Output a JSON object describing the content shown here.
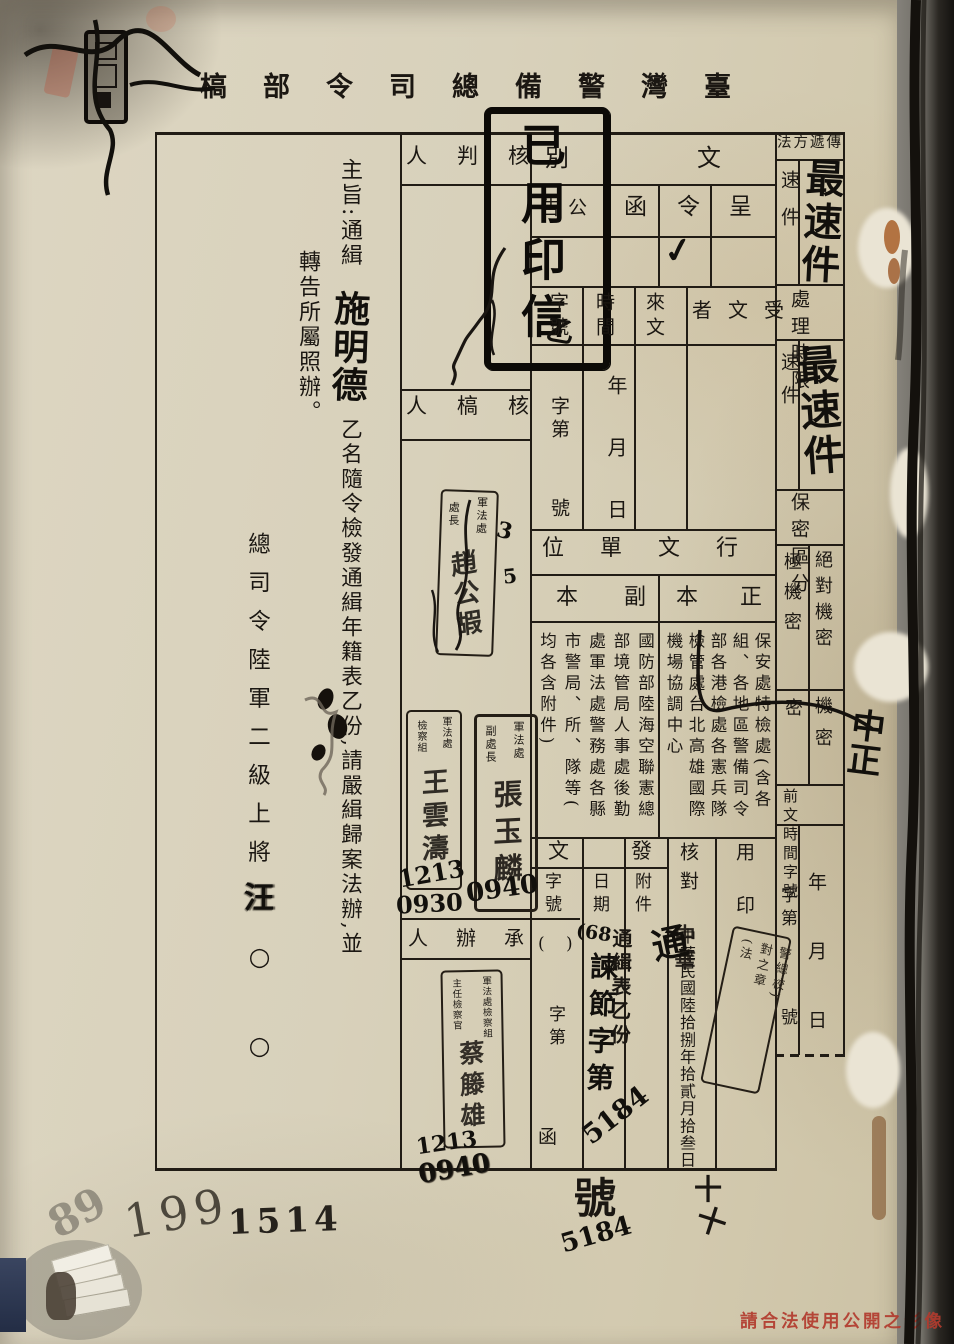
{
  "header": {
    "title": "臺灣警備總司令部槁"
  },
  "subject": {
    "label_and_opening": "主旨:通緝",
    "fugitive_name_hw": "施明德",
    "body_rest": "乙名隨令檢發通緝年籍表乙份,請嚴緝歸案法辦,並",
    "body_line2": "轉告所屬照辦。",
    "signer_title": "總司令陸軍二級上將",
    "signer_name_hw": "汪",
    "name_placeholders": "○○"
  },
  "doc_type": {
    "label": "文別",
    "options": [
      "呈",
      "令",
      "函",
      "公告"
    ],
    "check": "✓",
    "seal_box": {
      "text": "已用印信",
      "hw_note": "乙"
    }
  },
  "incoming": {
    "receiver_label": "受文者",
    "source_label": "來文",
    "time_label": "時間",
    "time_template": "年月日",
    "number_label": "字號",
    "number_prefix": "字第",
    "number_suffix": "號"
  },
  "dispatch_units": {
    "section_label": "行文單位",
    "original_label": "正本",
    "original_columns": [
      "保安處特檢處(含各",
      "組、各地區警備司令",
      "部各港檢處各憲兵隊",
      "檢管處台北高雄國際",
      "機場協調中心"
    ],
    "copy_label": "副本",
    "copy_columns": [
      "國防部陸海空聯憲總",
      "部境管局人事處後勤",
      "處軍法處警務處各縣",
      "市警局、所、隊等(",
      "均各含附件)"
    ]
  },
  "outgoing": {
    "section_label": "發文",
    "number_label": "字號",
    "number_parens": "( )",
    "number_prefix": "字第",
    "number_char_letter": "函",
    "date_label": "日期",
    "hw_year": "(68",
    "hw_code": "諫節字第",
    "hw_number": "5184",
    "attachment_label": "附件",
    "attachment_value": "通緝表乙份",
    "below_char": "號",
    "below_number_hw": "5184",
    "below_marks": [
      "十",
      "十"
    ]
  },
  "verification": {
    "label": "核對",
    "date_stamp": "中華民國陸拾捌年拾貳月拾叁日",
    "overstrike": "中華",
    "hw_mark": "通"
  },
  "sealing": {
    "label": "用印",
    "stamp_lines": [
      "警總校)",
      "對之章",
      "(法"
    ]
  },
  "transmission": {
    "method_label": "傳遞方法",
    "speed_option": "速件",
    "speed_stamp_hw": "最速件",
    "deadline_label": "處理時限",
    "deadline_option": "速件",
    "deadline_stamp_hw": "最速件",
    "secrecy_label": "保密區分",
    "secrecy_top_secret": "絕對機密",
    "secrecy_extreme": "極機密",
    "secrecy_confidential": "機密",
    "secrecy_secret": "密",
    "prev_doc_label": "前文時間字號",
    "prev_time_template": "年月日",
    "prev_number_prefix": "字第",
    "prev_number_suffix": "號",
    "margin_hw": "中正"
  },
  "staff": {
    "approver_label": "核判人",
    "reviewer_label": "核槁人",
    "handler_label": "承辦人",
    "stamp_reviewer": {
      "unit": "軍法處",
      "title": "處長",
      "name": "趙公嘏",
      "marks": [
        "3",
        "5"
      ]
    },
    "stamp_deputy": {
      "unit": "軍法處",
      "title": "副處長",
      "name": "張玉麟",
      "time_hw": "0940"
    },
    "stamp_section": {
      "unit": "軍法處",
      "title": "檢察組",
      "name": "王雲濤",
      "date_hw": "1213",
      "time_hw": "0930"
    },
    "stamp_prosecutor": {
      "unit": "軍法處檢察組",
      "title": "主任檢察官",
      "name": "蔡籐雄",
      "date_hw": "1213",
      "time_hw": "0940"
    }
  },
  "archive_marks": {
    "pencil_number": "89",
    "pen_number": "199",
    "stamp_number": "1514"
  },
  "footer_notice": "請合法使用公開之影像"
}
